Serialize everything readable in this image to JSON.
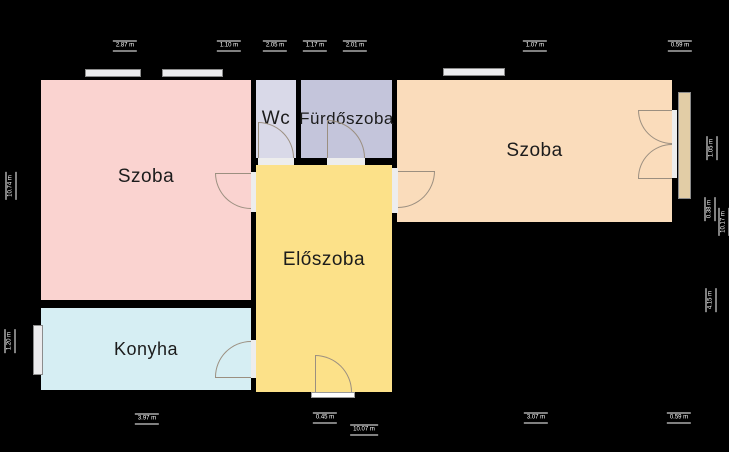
{
  "floorplan": {
    "rooms": {
      "szoba_left": "Szoba",
      "wc": "Wc",
      "furdoszoba": "Fürdőszoba",
      "szoba_right": "Szoba",
      "eloszoba": "Előszoba",
      "konyha": "Konyha"
    },
    "dimensions": {
      "t1": "2.87 m",
      "t2": "1.10 m",
      "t3": "2.05 m",
      "t4": "1.17 m",
      "t5": "2.01 m",
      "t6": "1.07 m",
      "t7": "0.59 m",
      "b1": "3.97 m",
      "b2": "0.45 m",
      "b3": "10.07 m",
      "b4": "3.07 m",
      "b5": "0.59 m",
      "l1": "10.74 m",
      "l2": "1.20 m",
      "r1": "1.05 m",
      "r2": "0.38 m",
      "r3": "10.17 m",
      "r4": "4.15 m"
    },
    "colors": {
      "background": "#000000",
      "room_szoba_left": "#fad3d0",
      "room_wc": "#d9d9e8",
      "room_furdoszoba": "#c4c5db",
      "room_szoba_right": "#fadcbb",
      "room_eloszoba": "#fce189",
      "room_konyha": "#d6eef3",
      "window_fill": "#ececee",
      "balcony_panel": "#e2cda6",
      "door_arc": "#9b8f80",
      "dim_badge_bg": "#000000",
      "dim_badge_text": "#ffffff"
    }
  }
}
